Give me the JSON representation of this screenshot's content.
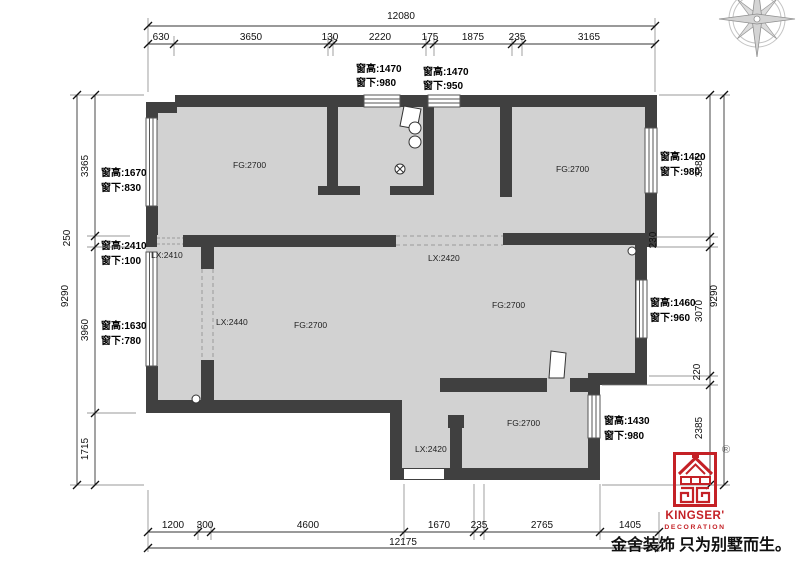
{
  "dims": {
    "top": {
      "total": "12080",
      "segs": [
        "630",
        "3650",
        "130",
        "2220",
        "175",
        "1875",
        "235",
        "3165"
      ]
    },
    "bottom": {
      "total": "12175",
      "segs": [
        "1200",
        "300",
        "4600",
        "1670",
        "235",
        "2765",
        "1405"
      ]
    },
    "left": {
      "total": "9290",
      "segs": [
        "3365",
        "250",
        "3960",
        "1715"
      ]
    },
    "right": {
      "total": "9290",
      "segs": [
        "3385",
        "230",
        "3070",
        "220",
        "2385"
      ]
    }
  },
  "windows": {
    "top1": {
      "l1": "窗高:1470",
      "l2": "窗下:980"
    },
    "top2": {
      "l1": "窗高:1470",
      "l2": "窗下:950"
    },
    "left1": {
      "l1": "窗高:1670",
      "l2": "窗下:830"
    },
    "left2": {
      "l1": "窗高:2410",
      "l2": "窗下:100"
    },
    "left3": {
      "l1": "窗高:1630",
      "l2": "窗下:780"
    },
    "right1": {
      "l1": "窗高:1420",
      "l2": "窗下:980"
    },
    "right2": {
      "l1": "窗高:1460",
      "l2": "窗下:960"
    },
    "right3": {
      "l1": "窗高:1430",
      "l2": "窗下:980"
    }
  },
  "rooms": {
    "labels": [
      "FG:2700",
      "FG:2700",
      "FG:2700",
      "FG:2700",
      "FG:2700"
    ]
  },
  "beams": {
    "labels": [
      "LX:2410",
      "LX:2440",
      "LX:2420",
      "LX:2420"
    ]
  },
  "branding": {
    "name": "KINGSER'",
    "sub": "DECORATION",
    "reg": "®",
    "tagline": "金舍装饰 只为别墅而生。"
  },
  "colors": {
    "wall": "#404040",
    "room": "#d2d2d2",
    "brand_red": "#c42126"
  }
}
